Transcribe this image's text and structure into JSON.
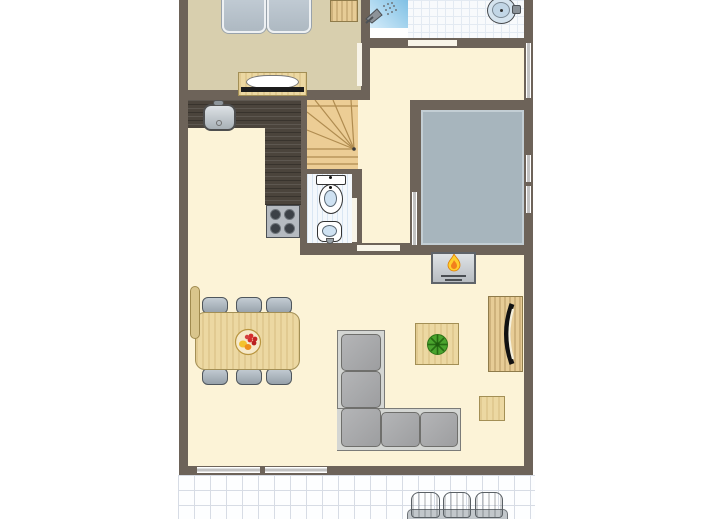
{
  "meta": {
    "kind": "floor-plan",
    "visible_text": []
  },
  "colors": {
    "wall": "#6d6359",
    "floor_living": "#fcf3d7",
    "floor_bedroom": "#d8cfae",
    "wood_light": "#ecd8a2",
    "wood_stairs": "#eccd95",
    "counter_dark": "#4b443c",
    "shower_blue": "#8cc6e8",
    "tile_white": "#f8fafc",
    "wc_stripe": "#d9e6f3",
    "patio_gray": "#a7b5bd",
    "sofa_gray": "#a9aaac",
    "chair_gray": "#a2acb5",
    "window_gray": "#c2c2c2",
    "flame_yellow": "#ffcf2e",
    "flame_orange": "#f2801d",
    "plant_green": "#4aa42e",
    "fruit_red": "#d42e2e",
    "fruit_yellow": "#f3c22e",
    "terrace_grid": "#d7dce5"
  },
  "rooms": [
    "bedroom",
    "bathroom",
    "landing",
    "staircase",
    "wc",
    "kitchen",
    "patio",
    "living-dining-room",
    "terrace"
  ],
  "elements": {
    "bedroom": [
      "double-bed",
      "wardrobe",
      "dresser"
    ],
    "bathroom": [
      "shower",
      "washbasin"
    ],
    "staircase": [
      "winder-stairs"
    ],
    "wc": [
      "toilet",
      "hand-basin"
    ],
    "kitchen": [
      "corner-counter",
      "kitchen-sink",
      "hob-4-burners"
    ],
    "living-dining-room": [
      "dining-table",
      "six-dining-chairs",
      "fruit-bowl",
      "corner-sofa",
      "coffee-table",
      "plant",
      "tv-sideboard",
      "side-table",
      "fireplace",
      "radiator"
    ],
    "terrace": [
      "garden-table",
      "three-garden-chairs"
    ]
  },
  "icons": [
    "shower-icon",
    "flame-icon",
    "plant-icon",
    "fruit-bowl-icon",
    "tv-icon"
  ]
}
